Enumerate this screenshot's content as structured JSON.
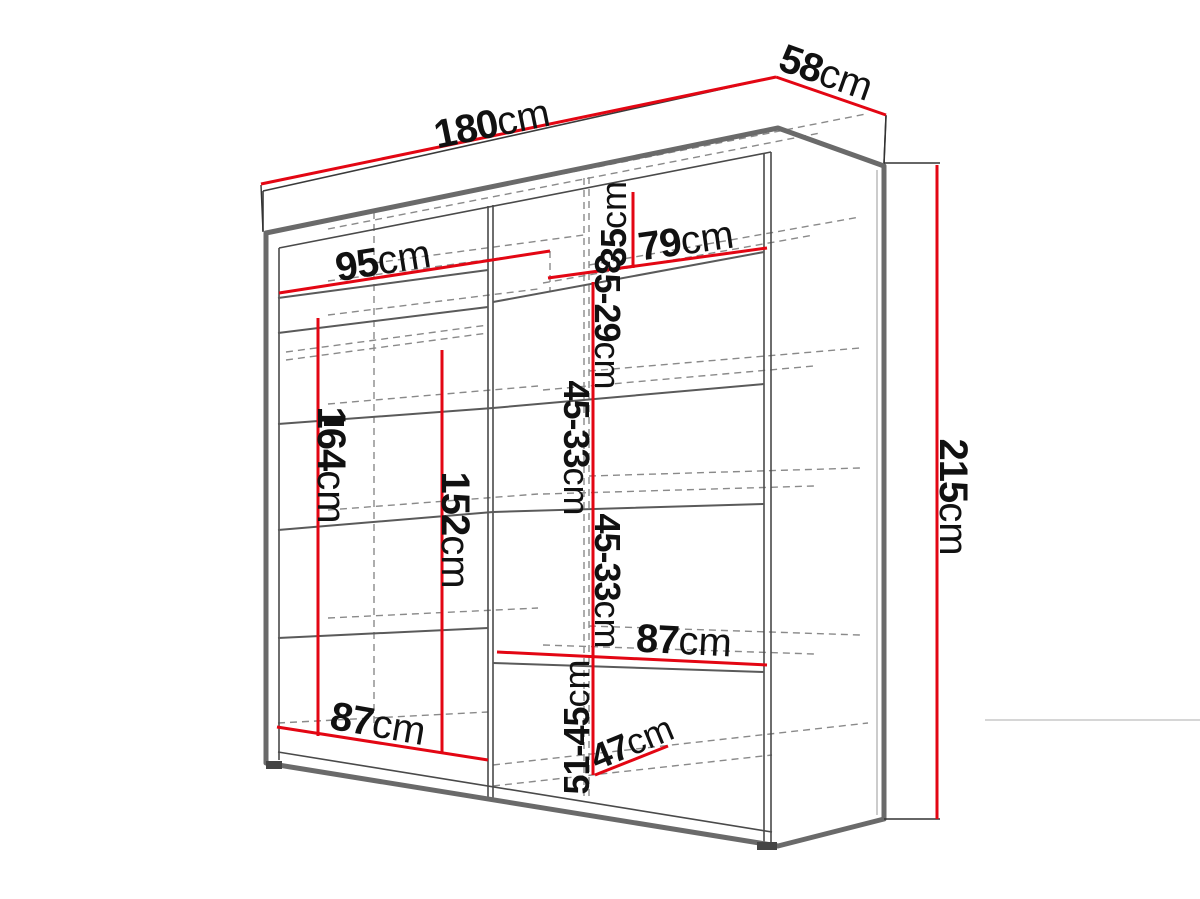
{
  "diagram": {
    "subject": "wardrobe-dimension-drawing",
    "background_color": "#ffffff",
    "dimension_line_color": "#e30613",
    "outline_color": "#6a6a6a",
    "text_color": "#111111"
  },
  "dimensions": {
    "width": {
      "value": "180",
      "unit": "cm"
    },
    "depth": {
      "value": "58",
      "unit": "cm"
    },
    "height": {
      "value": "215",
      "unit": "cm"
    },
    "left_shelf_width": {
      "value": "95",
      "unit": "cm"
    },
    "right_shelf_width": {
      "value": "79",
      "unit": "cm"
    },
    "top_cubby_height": {
      "value": "35",
      "unit": "cm"
    },
    "shelf_gap_top": {
      "value": "35-29",
      "unit": "cm"
    },
    "shelf_gap_mid": {
      "value": "45-33",
      "unit": "cm"
    },
    "shelf_gap_lower": {
      "value": "45-33",
      "unit": "cm"
    },
    "bottom_gap": {
      "value": "51-45",
      "unit": "cm"
    },
    "hanging_height": {
      "value": "164",
      "unit": "cm"
    },
    "inner_height": {
      "value": "152",
      "unit": "cm"
    },
    "lower_shelf_width": {
      "value": "87",
      "unit": "cm"
    },
    "left_bottom_width": {
      "value": "87",
      "unit": "cm"
    },
    "floor_depth": {
      "value": "47",
      "unit": "cm"
    }
  }
}
